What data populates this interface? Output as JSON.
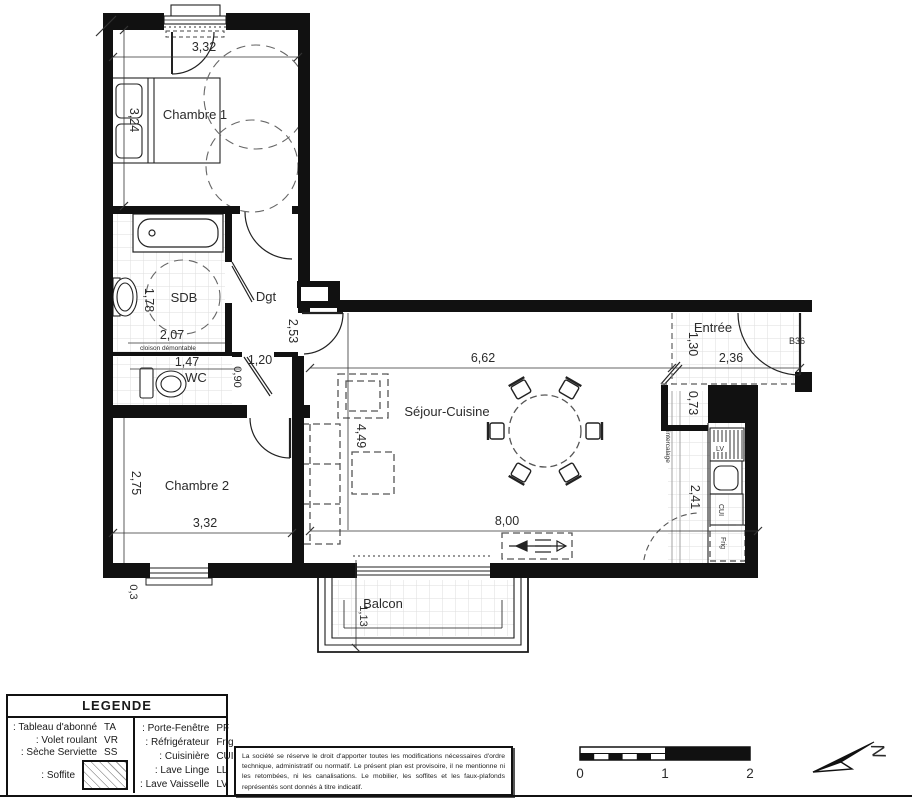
{
  "plan": {
    "rooms": {
      "chambre1": "Chambre 1",
      "sdb": "SDB",
      "dgt": "Dgt",
      "wc": "WC",
      "chambre2": "Chambre 2",
      "sejour": "Séjour-Cuisine",
      "entree": "Entrée",
      "balcon": "Balcon"
    },
    "dims": {
      "chambre1_w": "3,32",
      "chambre1_h": "3,24",
      "sdb_h": "1,78",
      "sdb_w": "2,07",
      "dgt_h": "2,53",
      "wc_w": "1,47",
      "wc_door_w": "1,20",
      "wc_door_h": "0,90",
      "chambre2_h": "2,75",
      "chambre2_w": "3,32",
      "wall_offset": "0,3",
      "sejour_w": "6,62",
      "sejour_h": "4,49",
      "sejour_total_w": "8,00",
      "entree_h": "1,30",
      "entree_w": "2,36",
      "closet_w": "0,73",
      "kitchen_h": "2,41",
      "balcon_d": "1,13"
    },
    "notes": {
      "partition": "cloison démontable",
      "door_label": "B36",
      "kitchen_strip": "intercalage"
    },
    "appliances": {
      "dishwasher": "LV",
      "cooker": "CUI",
      "fridge": "Frig"
    }
  },
  "legend": {
    "title": "LEGENDE",
    "left": [
      {
        "label": ": Tableau d'abonné",
        "code": "TA"
      },
      {
        "label": ": Volet roulant",
        "code": "VR"
      },
      {
        "label": ": Sèche Serviette",
        "code": "SS"
      },
      {
        "label": ": Soffite",
        "code": ""
      }
    ],
    "right": [
      {
        "label": ": Porte-Fenêtre",
        "code": "PF"
      },
      {
        "label": ": Réfrigérateur",
        "code": "Frig"
      },
      {
        "label": ": Cuisinière",
        "code": "CUI"
      },
      {
        "label": ": Lave Linge",
        "code": "LL"
      },
      {
        "label": ": Lave Vaisselle",
        "code": "LV"
      }
    ]
  },
  "disclaimer": "La société se réserve le droit d'apporter toutes les modifications nécessaires d'ordre technique, administratif ou normatif. Le présent plan est provisoire, il ne mentionne ni les retombées, ni les canalisations. Le mobilier, les soffites et les faux-plafonds représentés sont donnés à titre indicatif.",
  "scale_bar": {
    "t0": "0",
    "t1": "1",
    "t2": "2"
  },
  "north": {
    "letter": "N"
  }
}
